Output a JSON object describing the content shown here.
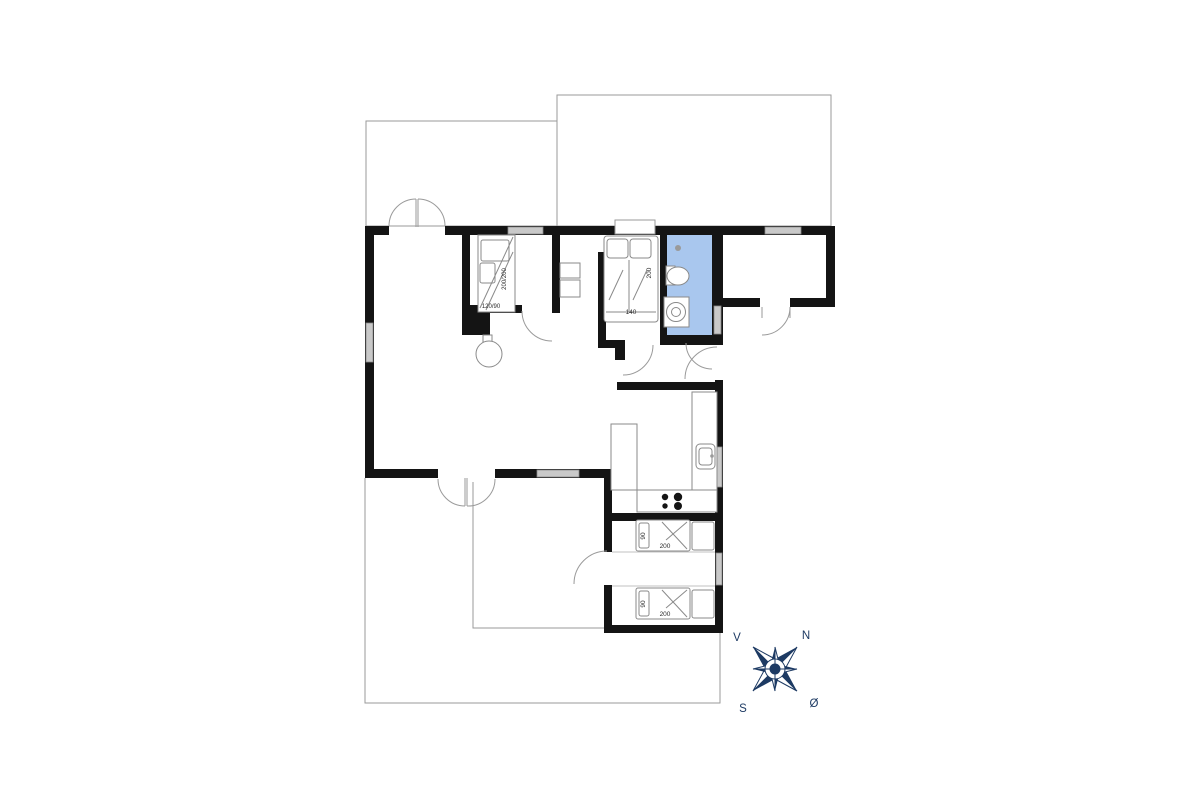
{
  "title": "Summerhouse floor plan",
  "colors": {
    "wall": "#141414",
    "outline": "#9a9a9a",
    "window": "#c9c9c9",
    "bathroom": "#a9c7ee",
    "compass": "#1d3a63",
    "background": "#ffffff"
  },
  "labels": {
    "bedroom1": {
      "bunk": "200/200",
      "bed": "120/90"
    },
    "bedroom2": {
      "length": "200",
      "width": "140"
    },
    "bedroom3": {
      "width": "90",
      "length": "200"
    },
    "bedroom4": {
      "width": "90",
      "length": "200"
    }
  },
  "compass": {
    "north": "N",
    "west": "V",
    "south": "S",
    "east": "Ø"
  }
}
